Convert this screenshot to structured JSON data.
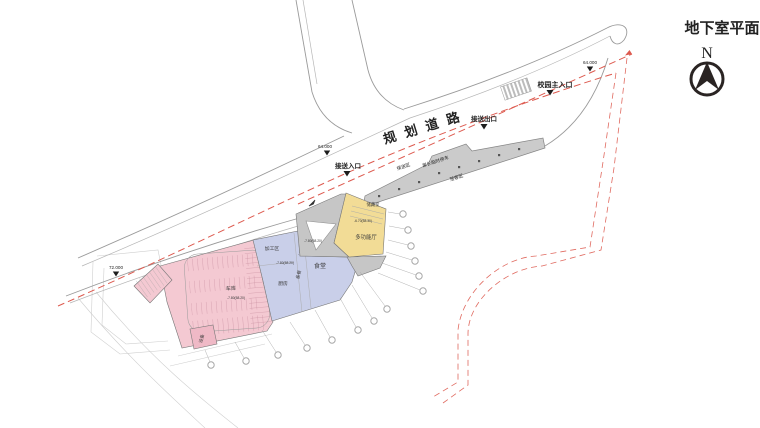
{
  "title": {
    "text": "地下室平面",
    "north": "N"
  },
  "road": {
    "name": "规划道路"
  },
  "markers": [
    {
      "label": "64.000"
    },
    {
      "label": "校园主入口"
    },
    {
      "label": "接送出口"
    },
    {
      "label": "64.000"
    },
    {
      "label": "接送入口"
    },
    {
      "label": "72.000"
    }
  ],
  "dropoff": {
    "labels": [
      "接送区",
      "家长临时停车",
      "落客区"
    ]
  },
  "rooms": {
    "storage": "储藏室",
    "multi_hall": "多功能厅",
    "canteen": "食堂",
    "prep": "备餐",
    "kitchen": "厨房",
    "process": "加工区",
    "garage": "车库",
    "equipment": "设备"
  },
  "levels": {
    "multi_hall": "-6.70(58.30)",
    "common": "-7.80(58.20)"
  },
  "colors": {
    "boundary_red": "#dd5a4f",
    "road_gray": "#9a9a9a",
    "strip_fill": "#cbcbcb",
    "hall_yellow": "#f2dc96",
    "canteen_blue": "#c9cfe9",
    "garage_pink": "#f4c9d2",
    "court_gray": "#c6c6c6"
  }
}
